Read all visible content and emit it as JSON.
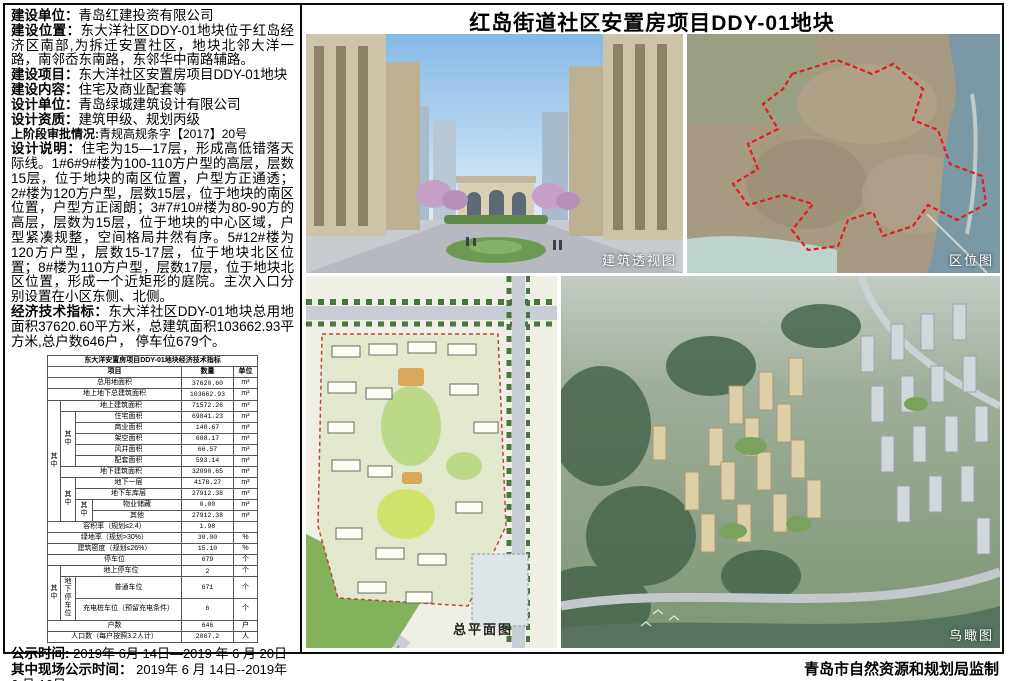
{
  "header": {
    "title": "红岛街道社区安置房项目DDY-01地块"
  },
  "left": {
    "fields": [
      {
        "label": "建设单位：",
        "text": "青岛红建投资有限公司"
      },
      {
        "label": "建设位置：",
        "text": "东大洋社区DDY-01地块位于红岛经济区南部,为拆迁安置社区，地块北邻大洋一路，南邻岙东南路，东邻华中南路辅路。"
      },
      {
        "label": "建设项目：",
        "text": "东大洋社区安置房项目DDY-01地块"
      },
      {
        "label": "建设内容：",
        "text": "住宅及商业配套等"
      },
      {
        "label": "设计单位：",
        "text": "青岛绿城建筑设计有限公司"
      },
      {
        "label": "设计资质：",
        "text": "建筑甲级、规划丙级"
      },
      {
        "label": "上阶段审批情况:",
        "text": "青规高规条字【2017】20号"
      },
      {
        "label": "设计说明：",
        "text": "住宅为15—17层，形成高低错落天际线。1#6#9#楼为100-110方户型的高层，层数15层，位于地块的南区位置，户型方正通透；2#楼为120方户型，层数15层，位于地块的南区位置，户型方正阔朗；3#7#10#楼为80-90方的高层，层数为15层，位于地块的中心区域，户型紧凑规整，空间格局井然有序。5#12#楼为120方户型，层数15-17层，位于地块北区位置；8#楼为110方户型，层数17层，位于地块北区位置，形成一个近矩形的庭院。主次入口分别设置在小区东侧、北侧。"
      },
      {
        "label": "经济技术指标：",
        "text": "东大洋社区DDY-01地块总用地面积37620.60平方米，总建筑面积103662.93平方米,总户数646户， 停车位679个。"
      }
    ],
    "notice": [
      {
        "label": "公示时间:",
        "text": " 2019年 6月 14日—2019 年 6 月 20日"
      },
      {
        "label": "其中现场公示时间：",
        "text": " 2019年 6 月 14日--2019年 6 月 16日"
      },
      {
        "label": "反馈方式:",
        "text": "电话66966903， 公示意见箱"
      }
    ]
  },
  "table": {
    "title": "东大洋安置房项目DDY-01地块经济技术指标",
    "col_item": "项目",
    "col_qty": "数量",
    "col_unit": "单位",
    "qizhong": "其中",
    "underground_parking": "地下停车位",
    "rows": [
      {
        "label": "总用地面积",
        "qty": "37620.60",
        "unit": "m²"
      },
      {
        "label": "地上地下总建筑面积",
        "qty": "103662.93",
        "unit": "m²"
      },
      {
        "label": "地上建筑面积",
        "qty": "71572.26",
        "unit": "m²"
      },
      {
        "label": "住宅面积",
        "qty": "69841.23",
        "unit": "m²"
      },
      {
        "label": "商业面积",
        "qty": "140.67",
        "unit": "m²"
      },
      {
        "label": "架空面积",
        "qty": "608.17",
        "unit": "m²"
      },
      {
        "label": "风井面积",
        "qty": "66.57",
        "unit": "m²"
      },
      {
        "label": "配套面积",
        "qty": "593.14",
        "unit": "m²"
      },
      {
        "label": "地下建筑面积",
        "qty": "32090.65",
        "unit": "m²"
      },
      {
        "label": "地下一层",
        "qty": "4178.27",
        "unit": "m²"
      },
      {
        "label": "地下车库层",
        "qty": "27912.38",
        "unit": "m²"
      },
      {
        "label": "物业储藏",
        "qty": "0.00",
        "unit": "m²"
      },
      {
        "label": "其他",
        "qty": "27912.38",
        "unit": "m²"
      },
      {
        "label": "容积率（规划≤2.4）",
        "qty": "1.98",
        "unit": ""
      },
      {
        "label": "绿地率（规划>30%）",
        "qty": "30.00",
        "unit": "%"
      },
      {
        "label": "建筑密度（规划≤26%）",
        "qty": "15.10",
        "unit": "%"
      },
      {
        "label": "停车位",
        "qty": "679",
        "unit": "个"
      },
      {
        "label": "地上停车位",
        "qty": "2",
        "unit": "个"
      },
      {
        "label": "普通车位",
        "qty": "671",
        "unit": "个"
      },
      {
        "label": "充电桩车位（预留充电条件）",
        "qty": "6",
        "unit": "个"
      },
      {
        "label": "户数",
        "qty": "646",
        "unit": "户"
      },
      {
        "label": "人口数（每户按照3.2人计）",
        "qty": "2067.2",
        "unit": "人"
      }
    ]
  },
  "captions": {
    "perspective": "建筑透视图",
    "location": "区位图",
    "siteplan": "总平面图",
    "aerial": "鸟瞰图"
  },
  "footer": {
    "credit": "青岛市自然资源和规划局监制"
  },
  "colors": {
    "boundary_red": "#e51c1c",
    "border_black": "#0a0a0a"
  }
}
